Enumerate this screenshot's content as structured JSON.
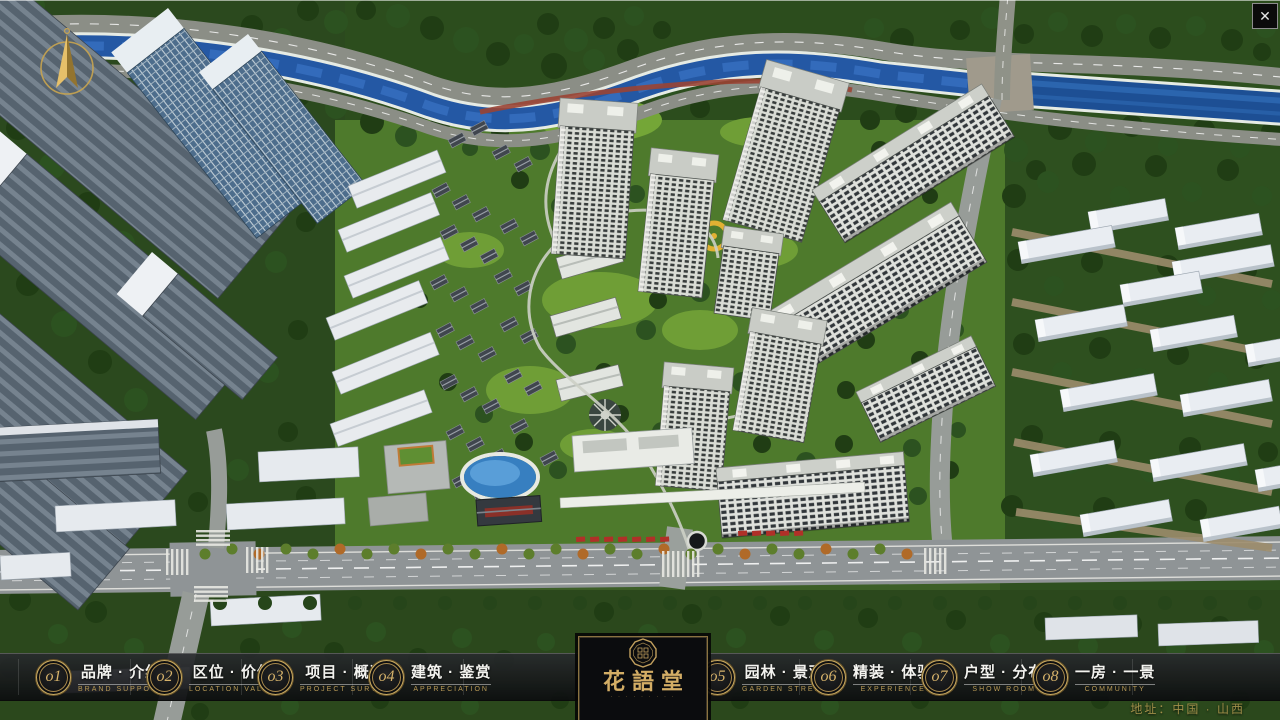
{
  "window": {
    "close": "✕"
  },
  "menu": {
    "items": [
      {
        "num": "o1",
        "zh": "品牌 · 介绍",
        "en": "BRAND SUPPORT"
      },
      {
        "num": "o2",
        "zh": "区位 · 价值",
        "en": "LOCATION VALUE"
      },
      {
        "num": "o3",
        "zh": "项目 · 概况",
        "en": "PROJECT SURVEY"
      },
      {
        "num": "o4",
        "zh": "建筑 · 鉴赏",
        "en": "APPRECIATION"
      },
      {
        "num": "o5",
        "zh": "园林 · 景观",
        "en": "GARDEN STREET"
      },
      {
        "num": "o6",
        "zh": "精装 · 体验",
        "en": "EXPERIENCE"
      },
      {
        "num": "o7",
        "zh": "户型 · 分布",
        "en": "SHOW ROOM"
      },
      {
        "num": "o8",
        "zh": "一房 · 一景",
        "en": "COMMUNITY"
      }
    ]
  },
  "logo": {
    "name": "花語堂",
    "tagline": "· · · · · · · · ·"
  },
  "footer": {
    "address": "地址：中国 · 山西"
  },
  "colors": {
    "accent_gold": "#c2a05e",
    "bar_background": "#141619",
    "river_blue": "#2458a4",
    "lawn_green": "#4e7a2c",
    "menu_text": "#f3f3ef"
  }
}
